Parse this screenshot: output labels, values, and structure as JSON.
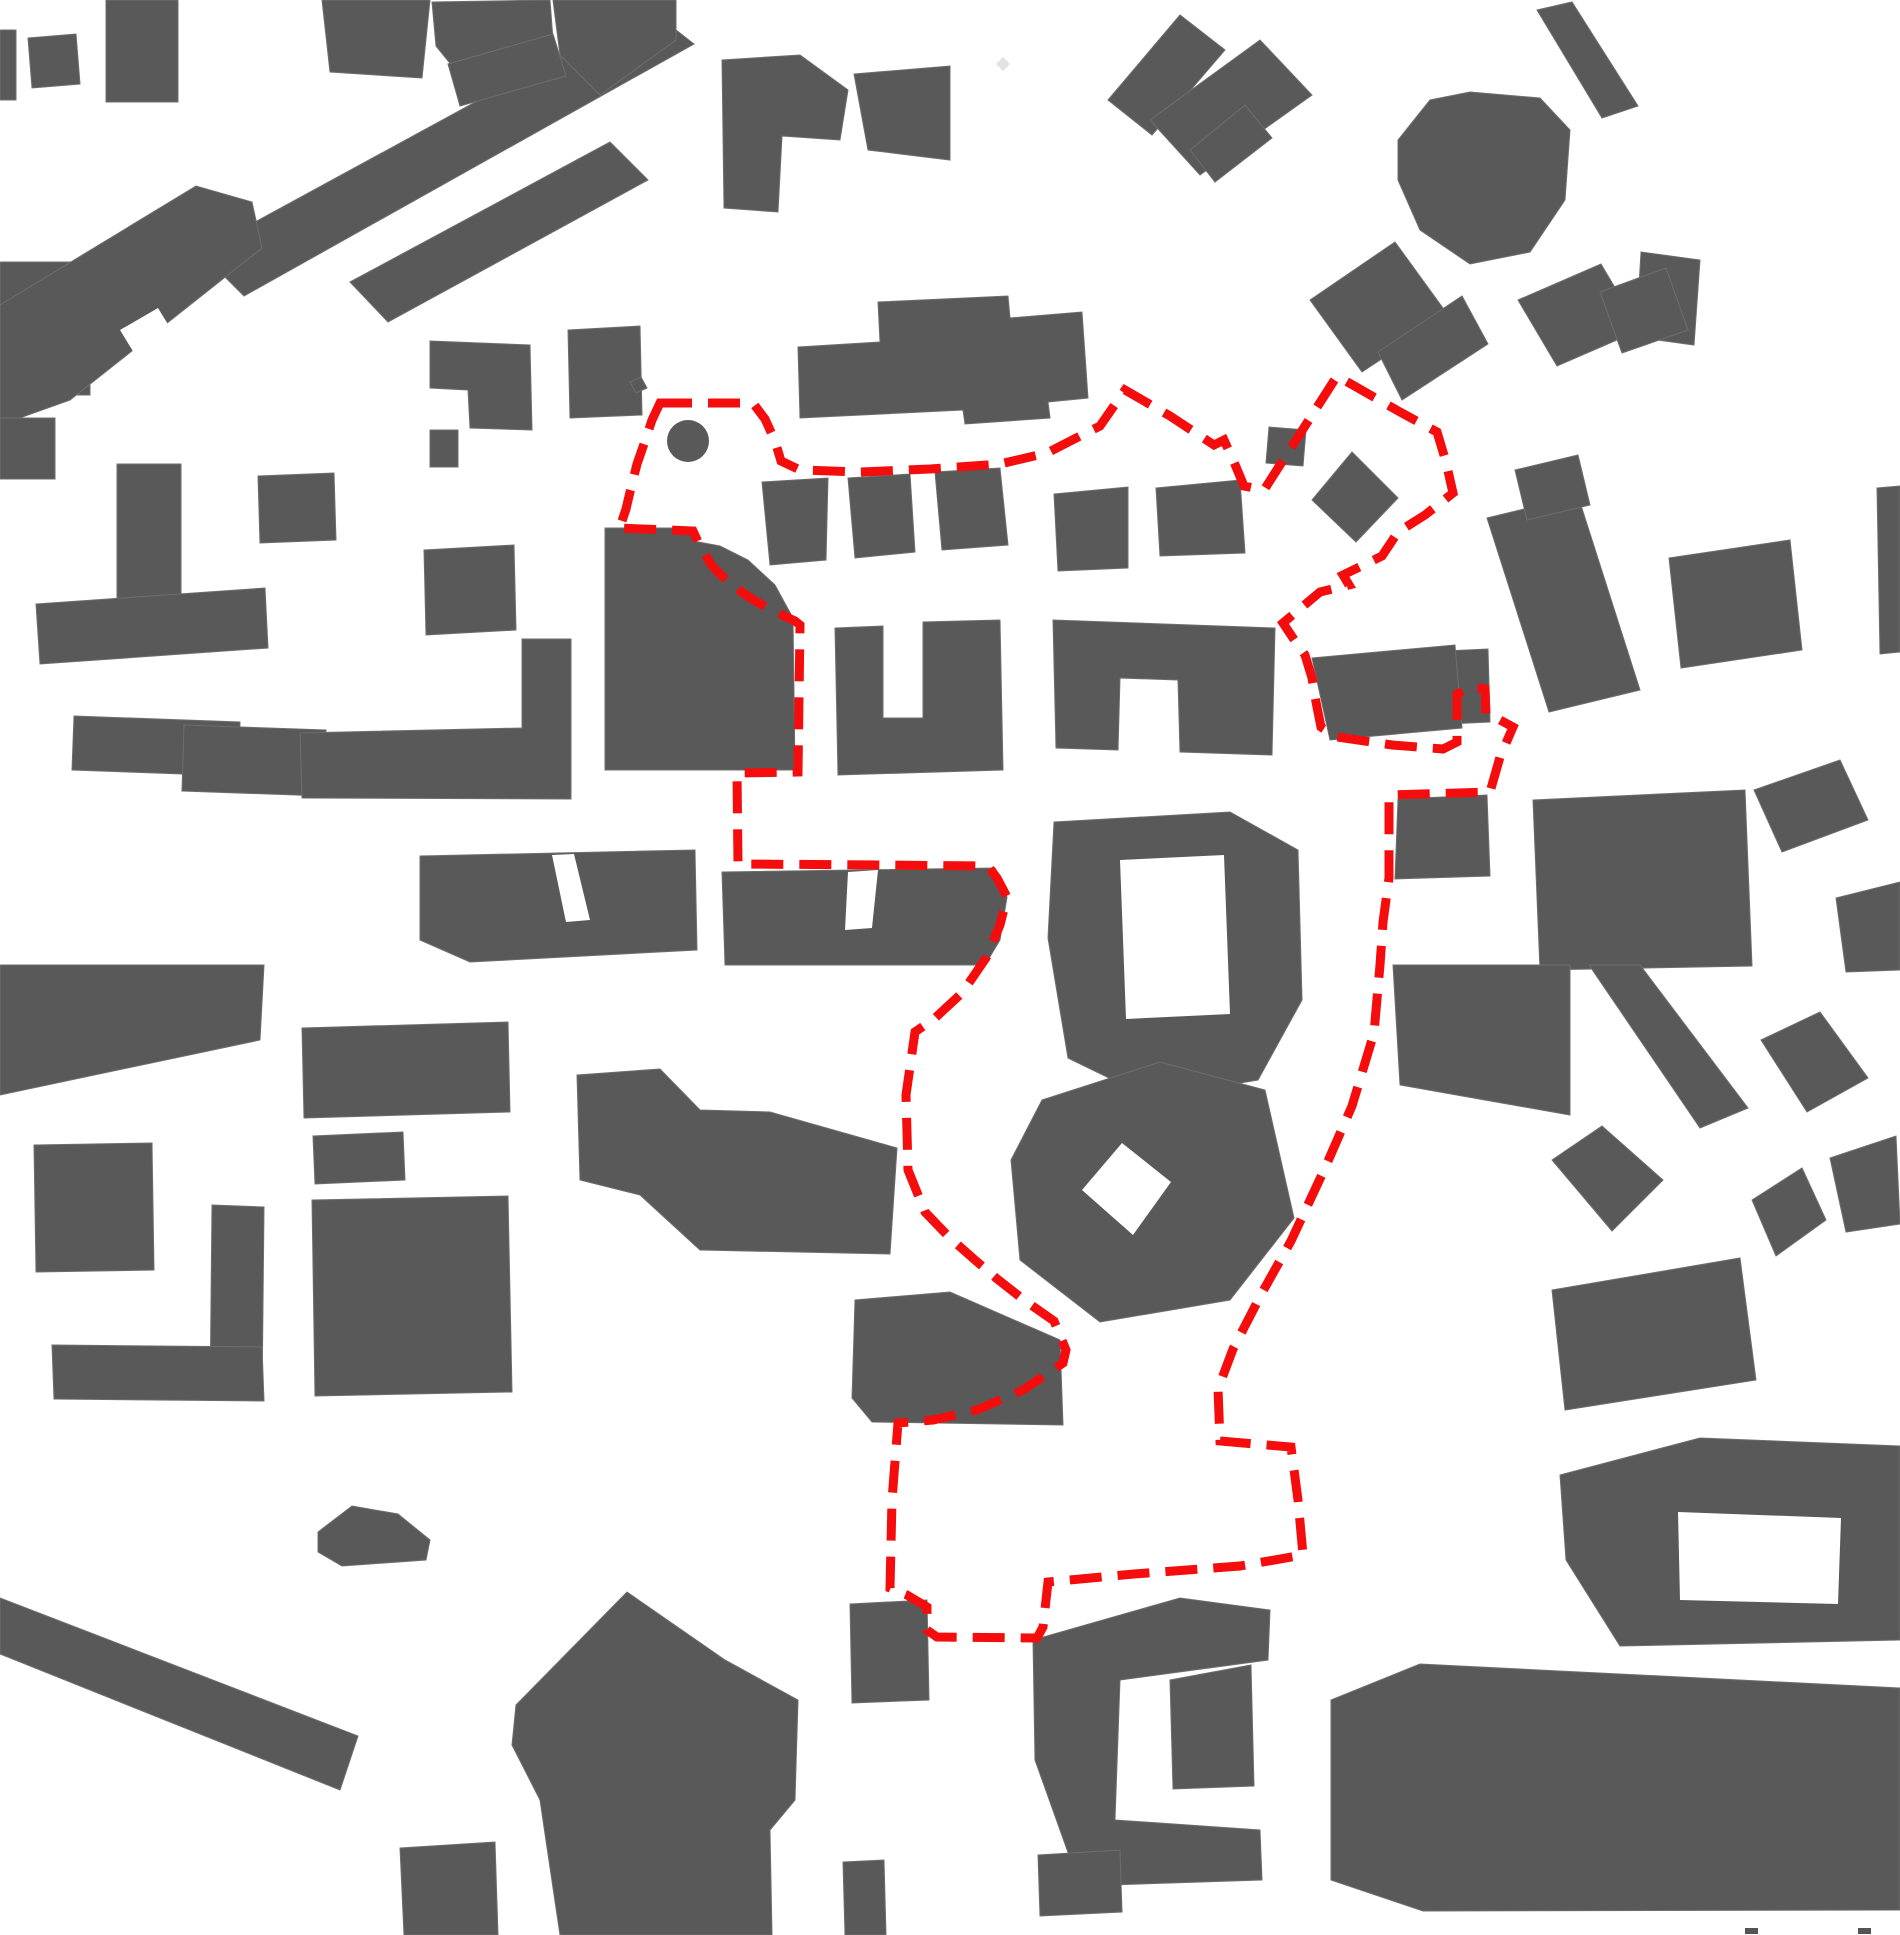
{
  "meta": {
    "description": "Figure-ground urban site plan with dashed red site boundary",
    "canvas": {
      "width": 1900,
      "height": 1935
    }
  },
  "colors": {
    "background": "#ffffff",
    "building": "#595959",
    "building_outline": "#6e6e6e",
    "building_light": "#e2e2e2",
    "boundary": "#f50d0d",
    "edge_mark": "#555555"
  },
  "boundary": {
    "stroke_width": 9,
    "dash": "32 16",
    "points": "660,403 753,403 765,419 775,441 781,461 800,470 860,472 930,469 1000,464 1047,453 1080,436 1100,426 1125,390 1170,416 1214,445 1224,440 1234,462 1244,486 1264,490 1337,376 1400,412 1437,432 1446,462 1453,493 1425,515 1398,532 1382,556 1343,575 1349,585 1320,592 1283,623 1293,638 1305,655 1312,678 1316,702 1321,727 1337,737 1392,745 1443,749 1457,742 1457,694 1472,687 1485,689 1486,714 1500,720 1513,727 1500,757 1490,792 1389,795 1389,878 1383,922 1380,965 1374,1033 1352,1106 1325,1168 1291,1241 1263,1291 1233,1349 1218,1389 1220,1441 1291,1447 1298,1500 1303,1555 1240,1566 1134,1574 1048,1582 1043,1627 1037,1638 937,1637 927,1630 927,1607 907,1595 890,1588 892,1500 898,1423 933,1420 977,1410 1023,1390 1063,1363 1066,1350 1054,1321 1024,1300 996,1278 975,1260 950,1238 925,1212 908,1170 906,1095 915,1032 935,1018 962,993 986,958 1000,925 1007,897 997,878 988,866 880,865 738,864 737,773 798,772 800,625 795,621 780,614 755,601 730,584 712,566 700,546 693,531 617,528 621,524 626,509 630,492 637,464 645,441 652,420"
  },
  "landmarks": {
    "round_tower": {
      "cx": 688,
      "cy": 441,
      "r": 21
    }
  },
  "buildings": [
    {
      "points": "0,30 16,30 16,100 0,100"
    },
    {
      "points": "28,38 76,34 80,84 32,88"
    },
    {
      "points": "106,0 178,0 178,102 106,102"
    },
    {
      "points": "200,252 648,8 694,44 244,296"
    },
    {
      "points": "432,2 550,0 553,40 470,88 436,46"
    },
    {
      "points": "553,0 676,0 676,40 600,95 560,55"
    },
    {
      "points": "322,0 430,0 422,78 330,72"
    },
    {
      "points": "350,282 610,142 648,180 388,322"
    },
    {
      "points": "0,262 90,262 90,395 0,395"
    },
    {
      "points": "0,305 196,186 252,202 262,248 70,400 0,425"
    },
    {
      "points": "0,418 55,418 55,479 0,479"
    },
    {
      "points": "117,464 181,464 181,636 117,636"
    },
    {
      "points": "36,604 265,588 268,648 40,664"
    },
    {
      "points": "74,716 240,722 238,776 72,770"
    },
    {
      "points": "184,725 326,730 324,796 182,791"
    },
    {
      "points": "300,733 522,728 522,639 571,639 571,799 302,798"
    },
    {
      "points": "424,550 514,545 516,630 426,635"
    },
    {
      "points": "430,341 530,345 532,430 470,428 468,390 430,388"
    },
    {
      "points": "430,430 458,430 458,467 430,467"
    },
    {
      "points": "448,64 553,34 566,76 460,106"
    },
    {
      "points": "722,60 800,55 848,90 840,140 782,136 778,212 724,208"
    },
    {
      "points": "854,74 950,66 950,160 868,150"
    },
    {
      "points": "258,476 334,473 336,540 260,543"
    },
    {
      "points": "568,330 640,326 642,415 570,418"
    },
    {
      "points": "605,528 693,528 693,541 720,546 748,560 775,585 793,618 795,770 605,770"
    },
    {
      "points": "835,628 883,626 883,718 923,718 923,622 1000,620 1003,770 838,775"
    },
    {
      "points": "1053,620 1275,628 1272,755 1180,752 1178,680 1120,678 1118,750 1056,748"
    },
    {
      "points": "762,482 828,478 826,560 770,565"
    },
    {
      "points": "848,478 910,474 915,552 855,558"
    },
    {
      "points": "935,472 1000,468 1008,545 942,550"
    },
    {
      "points": "1054,494 1128,487 1128,568 1058,571"
    },
    {
      "points": "1156,488 1240,480 1245,553 1160,556"
    },
    {
      "points": "1269,427 1306,430 1303,466 1266,463"
    },
    {
      "points": "1312,500 1352,452 1398,498 1356,542"
    },
    {
      "points": "798,347 880,342 878,302 1008,296 1010,318 1082,312 1088,398 1048,402 1050,418 965,424 963,410 800,418"
    },
    {
      "points": "630,382 641,377 647,388 636,393"
    },
    {
      "points": "1108,100 1180,15 1225,50 1152,135"
    },
    {
      "points": "1150,120 1260,40 1312,95 1200,175"
    },
    {
      "points": "1190,150 1245,105 1272,138 1215,182"
    },
    {
      "points": "1398,140 1430,100 1470,92 1540,98 1570,130 1565,200 1530,252 1470,264 1420,230 1398,180"
    },
    {
      "points": "1537,10 1572,2 1638,106 1602,118"
    },
    {
      "points": "1641,252 1700,260 1694,345 1636,337"
    },
    {
      "points": "1310,300 1395,242 1448,315 1362,372"
    },
    {
      "points": "1378,352 1462,296 1488,344 1402,400"
    },
    {
      "points": "1518,300 1601,264 1640,330 1557,366"
    },
    {
      "points": "1600,292 1666,268 1688,330 1622,353"
    },
    {
      "points": "1487,518 1578,496 1640,690 1549,712"
    },
    {
      "points": "1515,470 1578,455 1590,505 1527,520"
    },
    {
      "points": "1669,558 1790,540 1802,650 1681,668"
    },
    {
      "points": "1877,488 1900,486 1900,652 1880,654"
    },
    {
      "points": "1401,653 1488,649 1490,722 1405,726"
    },
    {
      "points": "1312,658 1455,645 1462,728 1330,740"
    },
    {
      "points": "1054,822 1230,812 1298,850 1302,1000 1258,1080 1150,1098 1068,1058 1048,938"
    },
    {
      "points": "1398,799 1487,795 1490,876 1395,879"
    },
    {
      "points": "1533,800 1745,790 1752,966 1540,970"
    },
    {
      "points": "1754,790 1840,760 1868,820 1782,852"
    },
    {
      "points": "1836,898 1900,882 1900,970 1846,972"
    },
    {
      "points": "0,965 264,965 260,1040 0,1095"
    },
    {
      "points": "302,1028 508,1022 510,1112 304,1118"
    },
    {
      "points": "34,1145 152,1143 154,1270 36,1272"
    },
    {
      "points": "212,1205 264,1207 262,1401 210,1399"
    },
    {
      "points": "52,1345 262,1347 264,1401 54,1399"
    },
    {
      "points": "313,1136 403,1132 405,1180 315,1184"
    },
    {
      "points": "312,1200 508,1196 512,1392 315,1396"
    },
    {
      "points": "318,1532 352,1506 398,1514 430,1540 426,1560 342,1566 318,1552"
    },
    {
      "points": "0,1598 358,1736 340,1790 0,1654"
    },
    {
      "points": "516,1705 627,1592 725,1660 798,1700 795,1800 770,1830 772,1935 560,1935 540,1800 512,1745"
    },
    {
      "points": "577,1075 660,1069 700,1110 770,1112 897,1148 890,1254 700,1250 640,1195 580,1180"
    },
    {
      "points": "420,856 695,850 697,950 470,962 420,940"
    },
    {
      "points": "722,872 995,868 1007,897 1000,940 985,965 725,965"
    },
    {
      "points": "855,1300 950,1292 1060,1340 1063,1425 872,1422 852,1398"
    },
    {
      "points": "850,1604 927,1600 929,1700 852,1703"
    },
    {
      "points": "1042,1100 1160,1062 1265,1090 1294,1218 1230,1300 1100,1322 1020,1260 1011,1160"
    },
    {
      "points": "1393,965 1570,965 1570,1115 1400,1085"
    },
    {
      "points": "1552,1160 1602,1126 1663,1180 1612,1231"
    },
    {
      "points": "1589,965 1640,965 1748,1108 1700,1128"
    },
    {
      "points": "1761,1040 1820,1012 1868,1078 1807,1112"
    },
    {
      "points": "1830,1158 1896,1136 1900,1224 1846,1232"
    },
    {
      "points": "1552,1290 1740,1258 1756,1380 1565,1410"
    },
    {
      "points": "1752,1200 1802,1168 1826,1220 1776,1256"
    },
    {
      "points": "1560,1475 1700,1438 1900,1446 1900,1640 1620,1646 1566,1560"
    },
    {
      "points": "1033,1640 1180,1598 1270,1610 1268,1660 1120,1680 1115,1820 1260,1830 1262,1880 1080,1886 1035,1760"
    },
    {
      "points": "1170,1680 1251,1665 1254,1786 1173,1789"
    },
    {
      "points": "1331,1700 1420,1664 1900,1688 1900,1910 1423,1911 1331,1880"
    },
    {
      "points": "1038,1855 1120,1850 1122,1912 1040,1916"
    },
    {
      "points": "400,1848 495,1842 498,1935 404,1935"
    },
    {
      "points": "843,1862 884,1860 886,1935 845,1935"
    }
  ],
  "courtyard_voids": [
    {
      "points": "120,330 158,308 180,344 142,366"
    },
    {
      "points": "1120,860 1224,855 1230,1014 1126,1019"
    },
    {
      "points": "1082,1190 1122,1143 1171,1182 1133,1235"
    },
    {
      "points": "1678,1512 1841,1518 1838,1604 1680,1600"
    },
    {
      "points": "848,872 878,870 872,928 845,930"
    },
    {
      "points": "552,855 574,854 590,920 566,922"
    }
  ],
  "accents": [
    {
      "points": "996,64 1003,57 1010,64 1003,71"
    }
  ],
  "edge_marks": [
    {
      "x": 1745,
      "y": 1928,
      "w": 13,
      "h": 6
    },
    {
      "x": 1858,
      "y": 1928,
      "w": 13,
      "h": 6
    }
  ]
}
